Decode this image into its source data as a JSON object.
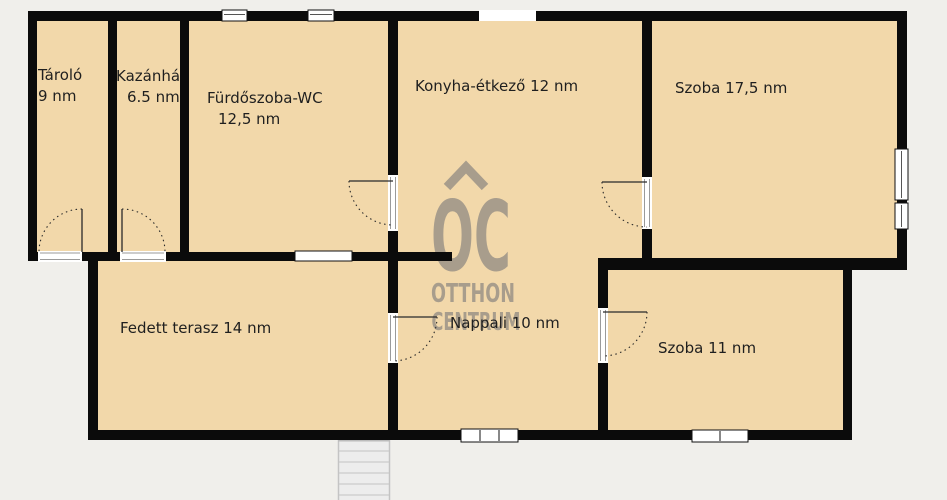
{
  "plan": {
    "type": "floor-plan",
    "language": "hu",
    "colors": {
      "background": "#f0efeb",
      "floor": "#f2d8aa",
      "wall": "#0b0b0b",
      "watermark": "#a89d8c",
      "label_text": "#1f1f1f",
      "stairs": "#ededed"
    },
    "rooms": [
      {
        "name": "Tároló",
        "area": "9 nm"
      },
      {
        "name": "Kazánház",
        "area": "6.5 nm"
      },
      {
        "name": "Fürdőszoba-WC",
        "area": "12,5 nm"
      },
      {
        "name": "Konyha-étkező",
        "area": "12 nm"
      },
      {
        "name": "Szoba",
        "area": "17,5 nm"
      },
      {
        "name": "Fedett terasz",
        "area": "14 nm"
      },
      {
        "name": "Nappali",
        "area": "10 nm"
      },
      {
        "name": "Szoba",
        "area": "11 nm"
      }
    ],
    "watermark": {
      "logo": "OC",
      "line1": "OTTHON",
      "line2": "CENTRUM"
    }
  }
}
